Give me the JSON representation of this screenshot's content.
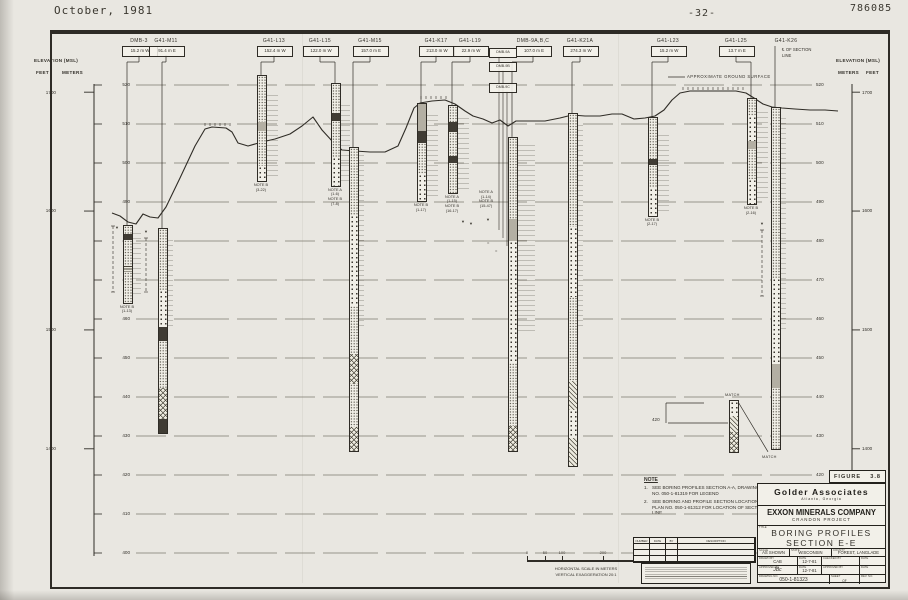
{
  "header": {
    "date": "October, 1981",
    "page_number": "-32-",
    "doc_number": "786085"
  },
  "axis_left": {
    "title": "ELEVATION (MSL)",
    "col1": "FEET",
    "col2": "METERS"
  },
  "axis_right": {
    "title": "ELEVATION (MSL)",
    "col1": "METERS",
    "col2": "FEET"
  },
  "elevation_scale": {
    "meters": [
      520,
      510,
      500,
      490,
      480,
      470,
      460,
      450,
      440,
      430,
      420,
      410,
      400
    ],
    "feet": [
      1700,
      1600,
      1500,
      1400
    ]
  },
  "ground_surface_label": "APPROXIMATE GROUND SURFACE",
  "ground_profile": [
    [
      112,
      213
    ],
    [
      120,
      216
    ],
    [
      128,
      222
    ],
    [
      136,
      224
    ],
    [
      143,
      214
    ],
    [
      150,
      217
    ],
    [
      158,
      218
    ],
    [
      166,
      207
    ],
    [
      180,
      178
    ],
    [
      195,
      146
    ],
    [
      205,
      129
    ],
    [
      212,
      127
    ],
    [
      226,
      128
    ],
    [
      232,
      132
    ],
    [
      238,
      143
    ],
    [
      248,
      146
    ],
    [
      262,
      142
    ],
    [
      275,
      139
    ],
    [
      290,
      134
    ],
    [
      302,
      126
    ],
    [
      313,
      117
    ],
    [
      322,
      130
    ],
    [
      333,
      142
    ],
    [
      342,
      150
    ],
    [
      355,
      151
    ],
    [
      370,
      152
    ],
    [
      385,
      152
    ],
    [
      398,
      146
    ],
    [
      406,
      128
    ],
    [
      414,
      108
    ],
    [
      420,
      103
    ],
    [
      432,
      101
    ],
    [
      445,
      100
    ],
    [
      455,
      104
    ],
    [
      465,
      111
    ],
    [
      473,
      116
    ],
    [
      483,
      119
    ],
    [
      492,
      123
    ],
    [
      500,
      120
    ],
    [
      508,
      126
    ],
    [
      516,
      121
    ],
    [
      530,
      121
    ],
    [
      545,
      121
    ],
    [
      560,
      118
    ],
    [
      572,
      115
    ],
    [
      585,
      116
    ],
    [
      600,
      116
    ],
    [
      612,
      114
    ],
    [
      622,
      114
    ],
    [
      634,
      119
    ],
    [
      645,
      118
    ],
    [
      655,
      116
    ],
    [
      664,
      110
    ],
    [
      672,
      100
    ],
    [
      680,
      93
    ],
    [
      690,
      91
    ],
    [
      705,
      91
    ],
    [
      720,
      91
    ],
    [
      736,
      91
    ],
    [
      746,
      93
    ],
    [
      754,
      98
    ],
    [
      763,
      104
    ],
    [
      772,
      107
    ],
    [
      782,
      108
    ],
    [
      795,
      109
    ],
    [
      810,
      110
    ],
    [
      825,
      110
    ],
    [
      838,
      111
    ]
  ],
  "hachures": [
    {
      "x1": 205,
      "x2": 230,
      "y": 127
    },
    {
      "x1": 421,
      "x2": 447,
      "y": 100
    },
    {
      "x1": 683,
      "x2": 745,
      "y": 91
    }
  ],
  "borings": [
    {
      "id": "DMB-3",
      "offset": "15.2 m W",
      "label_x": 139,
      "col_x": 127,
      "top_m": 484.1,
      "bot_m": 464.4,
      "note": [
        "NOTE B",
        "(1-13)"
      ],
      "annot": {
        "y1": 233,
        "y2": 298,
        "w": 9
      },
      "segs": [
        [
          "st",
          0,
          0.1
        ],
        [
          "dk",
          0.1,
          0.18
        ],
        [
          "st",
          0.18,
          0.52
        ],
        [
          "ln",
          0.52,
          0.6
        ],
        [
          "st",
          0.6,
          1
        ]
      ]
    },
    {
      "id": "G41-M11",
      "offset": "91.4 m E",
      "label_x": 166,
      "col_x": 162,
      "top_m": 483.3,
      "bot_m": 431.0,
      "annot": {
        "y1": 240,
        "y2": 330,
        "w": 6
      },
      "segs": [
        [
          "st",
          0,
          0.3
        ],
        [
          "dt",
          0.3,
          0.48
        ],
        [
          "dk",
          0.48,
          0.55
        ],
        [
          "st",
          0.55,
          0.78
        ],
        [
          "hx",
          0.78,
          0.93
        ],
        [
          "dk",
          0.93,
          1
        ]
      ]
    },
    {
      "id": "G41-L13",
      "offset": "152.4 m W",
      "label_x": 274,
      "col_x": 261,
      "top_m": 522.6,
      "bot_m": 495.6,
      "note": [
        "NOTE B",
        "(3-22)"
      ],
      "annot": {
        "y1": 95,
        "y2": 176,
        "w": 12
      },
      "segs": [
        [
          "st",
          0,
          0.44
        ],
        [
          "gy",
          0.44,
          0.52
        ],
        [
          "st",
          0.52,
          0.86
        ],
        [
          "dt",
          0.86,
          1
        ]
      ]
    },
    {
      "id": "G41-L15",
      "offset": "122.0 m W",
      "label_x": 320,
      "col_x": 335,
      "top_m": 520.5,
      "bot_m": 494.4,
      "note": [
        "NOTE A",
        "(1-6)",
        "NOTE B",
        "(7-8)"
      ],
      "annot": {
        "y1": 105,
        "y2": 183,
        "w": 10
      },
      "segs": [
        [
          "st",
          0,
          0.28
        ],
        [
          "dk",
          0.28,
          0.36
        ],
        [
          "st",
          0.36,
          0.72
        ],
        [
          "dt",
          0.72,
          1
        ]
      ]
    },
    {
      "id": "G41-M15",
      "offset": "157.0 m E",
      "label_x": 370,
      "col_x": 353,
      "top_m": 504.1,
      "bot_m": 426.4,
      "annot": {
        "y1": 155,
        "y2": 330,
        "w": 6
      },
      "segs": [
        [
          "st",
          0,
          0.22
        ],
        [
          "dt",
          0.22,
          0.52
        ],
        [
          "st",
          0.52,
          0.68
        ],
        [
          "hx",
          0.68,
          0.78
        ],
        [
          "st",
          0.78,
          0.92
        ],
        [
          "hx",
          0.92,
          1
        ]
      ]
    },
    {
      "id": "G41-K17",
      "offset": "213.0 m W",
      "label_x": 436,
      "col_x": 421,
      "top_m": 515.4,
      "bot_m": 490.5,
      "note": [
        "NOTE B",
        "(1-17)"
      ],
      "annot": {
        "y1": 115,
        "y2": 197,
        "w": 12
      },
      "segs": [
        [
          "gy",
          0,
          0.28
        ],
        [
          "dk",
          0.28,
          0.4
        ],
        [
          "st",
          0.4,
          0.72
        ],
        [
          "dt",
          0.72,
          1
        ]
      ]
    },
    {
      "id": "G41-L19",
      "offset": "22.9 m W",
      "label_x": 470,
      "col_x": 452,
      "top_m": 514.9,
      "bot_m": 492.6,
      "note": [
        "NOTE A",
        "(1-15)",
        "NOTE B",
        "(16-17)"
      ],
      "annot": {
        "y1": 118,
        "y2": 190,
        "w": 12
      },
      "segs": [
        [
          "st",
          0,
          0.18
        ],
        [
          "dk",
          0.18,
          0.3
        ],
        [
          "st",
          0.3,
          0.58
        ],
        [
          "dk",
          0.58,
          0.66
        ],
        [
          "st",
          0.66,
          1
        ]
      ]
    },
    {
      "id": "DMB-9A,B,C",
      "offset": "107.0 m E",
      "label_x": 533,
      "col_x": 512,
      "top_m": 506.7,
      "bot_m": 426.4,
      "note": [
        "NOTE A",
        "(1-14)",
        "NOTE B",
        "(15-47)"
      ],
      "note_x": 486,
      "note_y": 190,
      "annot": {
        "y1": 145,
        "y2": 335,
        "w": 18
      },
      "segs": [
        [
          "st",
          0,
          0.26
        ],
        [
          "gy",
          0.26,
          0.33
        ],
        [
          "dt",
          0.33,
          0.72
        ],
        [
          "st",
          0.72,
          0.92
        ],
        [
          "hx",
          0.92,
          1
        ]
      ],
      "sub_boxes": [
        "DMB-9A",
        "DMB-9B",
        "DMB-9C"
      ]
    },
    {
      "id": "G41-K21A",
      "offset": "274.3 m W",
      "label_x": 580,
      "col_x": 572,
      "top_m": 512.8,
      "bot_m": 422.6,
      "annot": {
        "y1": 125,
        "y2": 330,
        "w": 6
      },
      "segs": [
        [
          "st",
          0,
          0.32
        ],
        [
          "dt",
          0.32,
          0.52
        ],
        [
          "st",
          0.52,
          0.76
        ],
        [
          "hh",
          0.76,
          0.84
        ],
        [
          "dt",
          0.84,
          0.92
        ],
        [
          "hh",
          0.92,
          1
        ]
      ]
    },
    {
      "id": "G41-L23",
      "offset": "15.2 m W",
      "label_x": 668,
      "col_x": 652,
      "top_m": 511.8,
      "bot_m": 486.7,
      "note": [
        "NOTE B",
        "(2-17)"
      ],
      "annot": {
        "y1": 135,
        "y2": 212,
        "w": 12
      },
      "segs": [
        [
          "st",
          0,
          0.42
        ],
        [
          "dk",
          0.42,
          0.48
        ],
        [
          "st",
          0.48,
          0.72
        ],
        [
          "dt",
          0.72,
          1
        ]
      ]
    },
    {
      "id": "G41-L25",
      "offset": "13.7 m E",
      "label_x": 736,
      "col_x": 751,
      "top_m": 516.7,
      "bot_m": 489.7,
      "note": [
        "NOTE B",
        "(2-16)"
      ],
      "annot": {
        "y1": 112,
        "y2": 200,
        "w": 12
      },
      "segs": [
        [
          "st",
          0,
          0.16
        ],
        [
          "dt",
          0.16,
          0.4
        ],
        [
          "gy",
          0.4,
          0.48
        ],
        [
          "st",
          0.48,
          0.76
        ],
        [
          "dt",
          0.76,
          1
        ]
      ]
    },
    {
      "id": "G41-K26",
      "offset": "",
      "cl_lines": [
        "℄ OF SECTION",
        "LINE"
      ],
      "label_x": 786,
      "col_x": 775,
      "top_m": 514.4,
      "bot_m": 426.9,
      "annot": {
        "y1": 118,
        "y2": 330,
        "w": 6
      },
      "segs": [
        [
          "st",
          0,
          0.5
        ],
        [
          "dt",
          0.5,
          0.75
        ],
        [
          "gy",
          0.75,
          0.82
        ],
        [
          "st",
          0.82,
          1
        ]
      ]
    }
  ],
  "match_detail": {
    "x": 733,
    "top_m": 439.2,
    "bot_m": 426.2,
    "label_top": "MATCH",
    "label_bottom": "MATCH",
    "elev_label": "420",
    "segs": [
      [
        "dt",
        0,
        0.3
      ],
      [
        "hh",
        0.3,
        0.6
      ],
      [
        "hx",
        0.6,
        1
      ]
    ]
  },
  "aux_lines": [
    {
      "x": 113,
      "y1": 226,
      "y2": 292
    },
    {
      "x": 146,
      "y1": 238,
      "y2": 292
    },
    {
      "x": 762,
      "y1": 230,
      "y2": 296
    }
  ],
  "markers": [
    {
      "x": 117,
      "y": 228
    },
    {
      "x": 146,
      "y": 232
    },
    {
      "x": 463,
      "y": 222
    },
    {
      "x": 471,
      "y": 224
    },
    {
      "x": 488,
      "y": 220
    },
    {
      "x": 762,
      "y": 224
    },
    {
      "x": 489,
      "y": 243,
      "g": "="
    },
    {
      "x": 497,
      "y": 251,
      "g": "="
    }
  ],
  "notes": {
    "heading": "NOTE",
    "items": [
      "SEE BORING PROFILES SECTION A-A, DRAWING NO. 050-1-81319 FOR LEGEND",
      "SEE BORING AND PROFILE SECTION LOCATION PLAN NO. 050-1-81312 FOR LOCATION OF SECTION LINE"
    ]
  },
  "scale_bar": {
    "tick_labels": [
      "0",
      "50",
      "100",
      "200",
      "300"
    ],
    "tick_x": [
      7,
      25,
      42,
      83,
      125
    ],
    "caption1": "HORIZONTAL SCALE IN METERS",
    "caption2": "VERTICAL EXAGGERATION 20:1"
  },
  "revision_table": {
    "headers": [
      "NUMBER",
      "DATE",
      "BY",
      "DESCRIPTION"
    ]
  },
  "title_block": {
    "figure_label": "FIGURE",
    "figure_number": "3.8",
    "company": "Golder Associates",
    "company_sub": "Atlanta, Georgia",
    "client": "EXXON MINERALS COMPANY",
    "project": "CRANDON PROJECT",
    "title_label": "TITLE",
    "title_line1": "BORING  PROFILES",
    "title_line2": "SECTION  E-E",
    "scale_label": "SCALE",
    "scale": "AS SHOWN",
    "state_label": "STATE",
    "state": "WISCONSIN",
    "county_label": "COUNTY",
    "county": "FOREST, LANGLADE",
    "drawn_label": "DRAWN BY",
    "drawn": "CAB",
    "date1_label": "DATE",
    "date1": "12-7-81",
    "checked_label": "CHECKED BY",
    "checked": "",
    "date2_label": "DATE",
    "date2": "",
    "approved_label": "APPROVED BY",
    "approved": "JBc",
    "date3_label": "DATE",
    "date3": "12-7-81",
    "approved2_label": "APPROVED BY",
    "approved2": "",
    "date4_label": "DATE",
    "date4": "",
    "drawing_no_label": "DRAWING NO.",
    "drawing_no": "050-1-81323",
    "sheet_label": "SHEET",
    "of_label": "OF",
    "rev_label": "REV. NO."
  },
  "colors": {
    "paper": "#e9e7e1",
    "ink": "#2f2c26",
    "grid": "#7d796e"
  }
}
